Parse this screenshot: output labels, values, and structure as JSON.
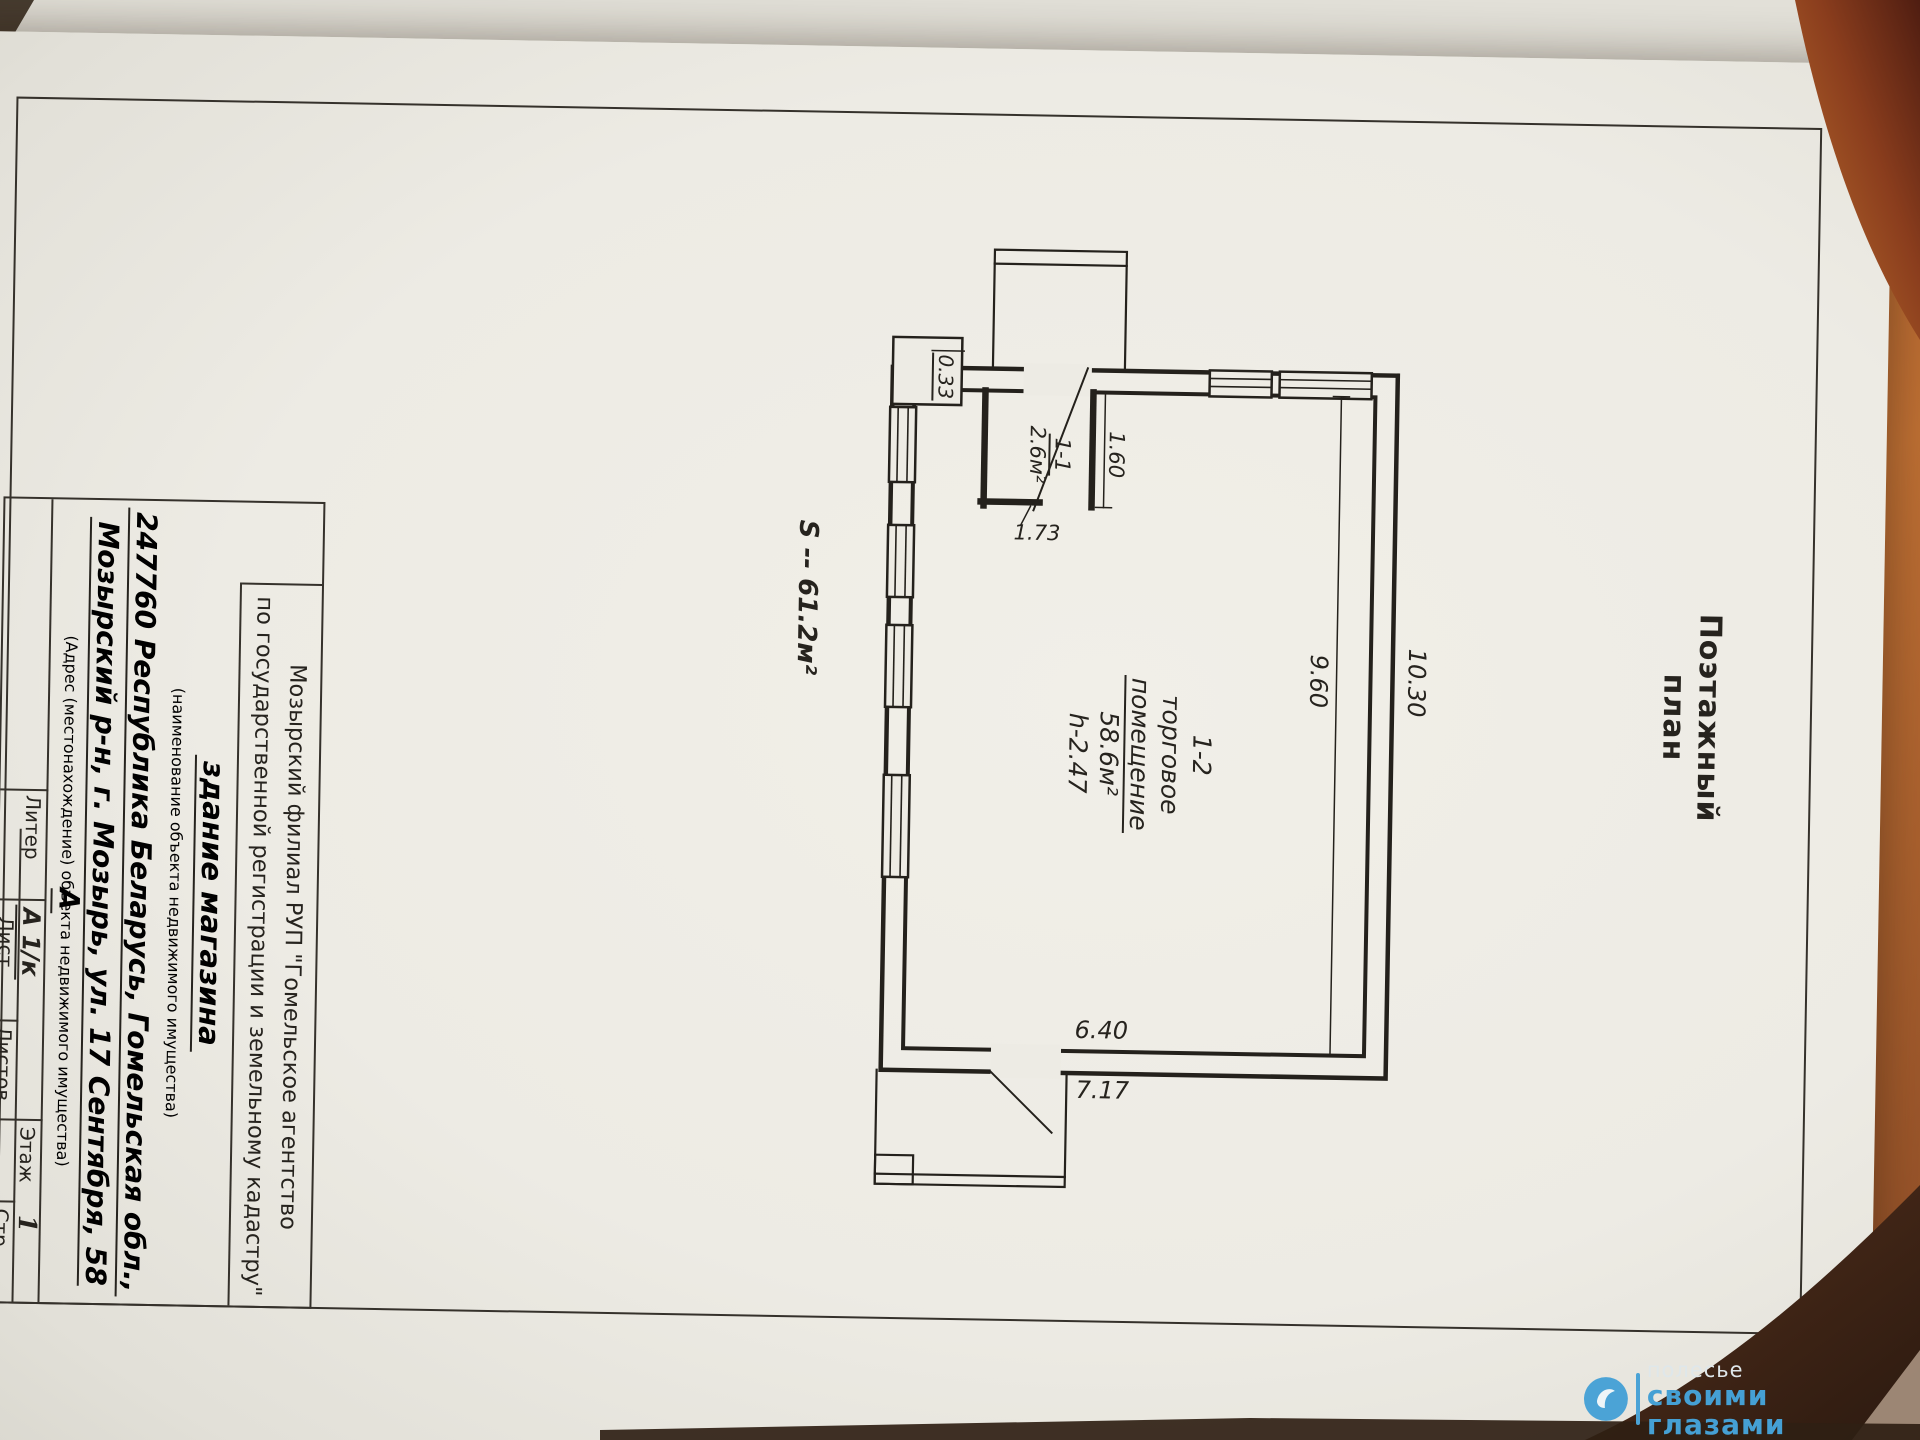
{
  "document": {
    "title": "Поэтажный план",
    "plan": {
      "area_total_label": "S -- 61.2м²",
      "dims": {
        "d1030": "10.30",
        "d960": "9.60",
        "d160": "1.60",
        "d033": "0.33",
        "d173": "1.73",
        "d640": "6.40",
        "d717": "7.17"
      },
      "room_main": {
        "number": "1-2",
        "name_line1": "торговое",
        "name_line2": "помещение",
        "area": "58.6м²",
        "height": "h-2.47"
      },
      "room_small": {
        "number": "1-1",
        "area": "2.6м²"
      }
    },
    "title_block": {
      "agency_line1": "Мозырский филиал РУП \"Гомельское агентство",
      "agency_line2": "по государственной регистрации и земельному кадастру\"",
      "object_name": "здание магазина",
      "object_name_caption": "(наименование объекта недвижимого имущества)",
      "address_line1": "247760 Республика Беларусь, Гомельская обл.,",
      "address_line2": "Мозырский р-н, г. Мозырь, ул. 17 Сентября, 58 А",
      "address_caption": "(Адрес (местонахождение) объекта недвижимого имущества)",
      "table": {
        "liter_label": "Литер",
        "liter_value": "А 1/к",
        "list_label": "Лист",
        "listov_label": "Листов",
        "floor_label": "Этаж",
        "floor_value": "1",
        "page_label": "Стр."
      }
    }
  },
  "photo": {
    "watermark": {
      "line1": "полесье",
      "line2": "своими глазами"
    }
  },
  "colors": {
    "watermark_blue": "#45a0d4",
    "paper": "#edebe4",
    "ink": "#26231e",
    "wood_dark": "#5f2718",
    "wood_light": "#b4682e"
  }
}
